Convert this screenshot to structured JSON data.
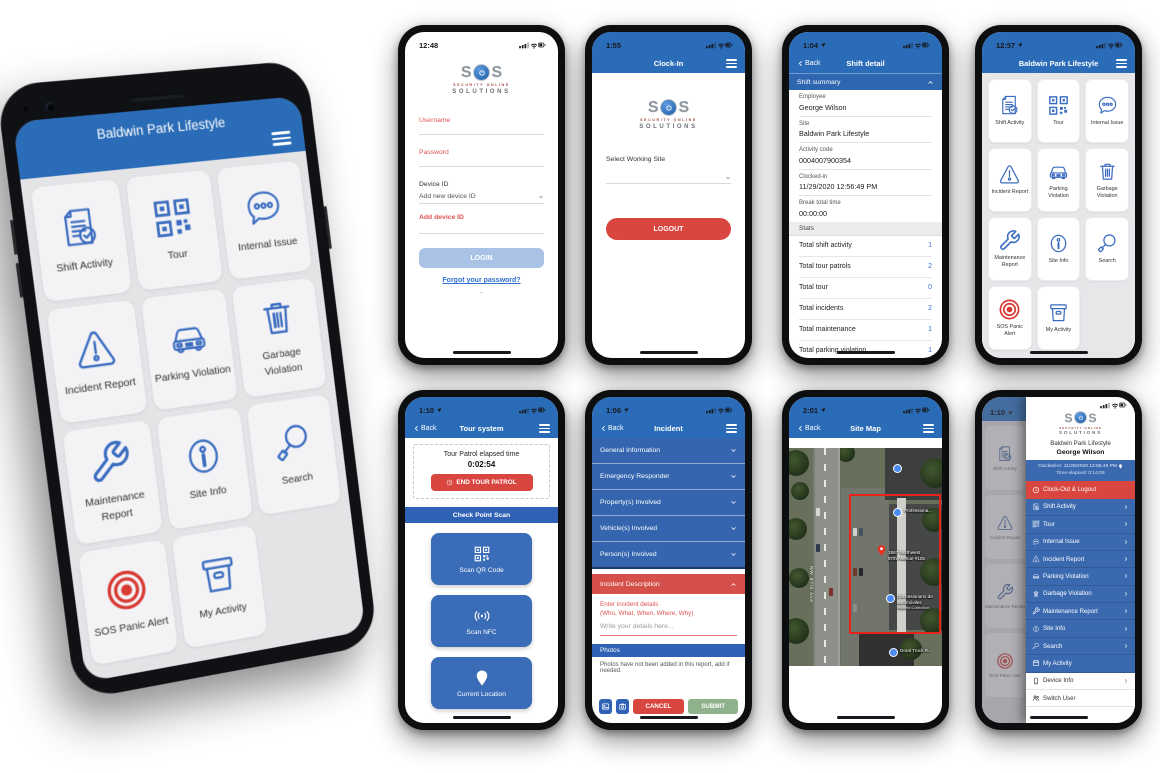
{
  "main_title": "Baldwin Park Lifestyle",
  "nav": {
    "back": "Back"
  },
  "logo": {
    "s_left": "S",
    "s_right": "S",
    "tagline1": "SECURITY ONLINE",
    "tagline2": "SOLUTIONS"
  },
  "colors": {
    "header_blue": "#2a6cb8",
    "row_blue": "#3a69b0",
    "accent_red": "#d9453f",
    "panic_red": "#d93a34",
    "icon_blue": "#3a6cc0",
    "submit_green": "#8fb18c",
    "login_button_blue": "#a9c2e6",
    "stat_value_blue": "#2f6fd0"
  },
  "status": {
    "login": "12:48",
    "clockin": "1:55",
    "shift": "1:04",
    "menu": "12:57",
    "tour": "1:10",
    "incident": "1:06",
    "map": "2:01",
    "drawer": "1:10"
  },
  "menu": {
    "items": [
      {
        "label": "Shift Activity"
      },
      {
        "label": "Tour"
      },
      {
        "label": "Internal Issue"
      },
      {
        "label": "Incident Report"
      },
      {
        "label": "Parking Violation"
      },
      {
        "label": "Garbage Violation"
      },
      {
        "label": "Maintenance Report"
      },
      {
        "label": "Site Info"
      },
      {
        "label": "Search"
      },
      {
        "label": "SOS Panic Alert"
      },
      {
        "label": "My Activity"
      }
    ]
  },
  "login": {
    "username_label": "Username",
    "password_label": "Password",
    "device_id_label": "Device ID",
    "device_id_value": "Add new device ID",
    "add_device_link": "Add device ID",
    "login_button": "LOGIN",
    "forgot_link": "Forgot your password?",
    "dash": "-"
  },
  "clockin": {
    "title": "Clock-In",
    "select_site_label": "Select Working Site",
    "logout_button": "LOGOUT"
  },
  "shift": {
    "title": "Shift detail",
    "summary_header": "Shift summary",
    "fields": [
      {
        "label": "Employee",
        "value": "George Wilson"
      },
      {
        "label": "Site",
        "value": "Baldwin Park Lifestyle"
      },
      {
        "label": "Activity code",
        "value": "0004007900354"
      },
      {
        "label": "Clocked-in",
        "value": "11/29/2020 12:56:49 PM"
      },
      {
        "label": "Break total time",
        "value": "00:00:00"
      }
    ],
    "stats_header": "Stats",
    "stats": [
      {
        "label": "Total shift activity",
        "value": "1"
      },
      {
        "label": "Total tour patrols",
        "value": "2"
      },
      {
        "label": "Total tour",
        "value": "0"
      },
      {
        "label": "Total incidents",
        "value": "2"
      },
      {
        "label": "Total maintenance",
        "value": "1"
      },
      {
        "label": "Total parking violation",
        "value": "1"
      }
    ]
  },
  "tour": {
    "title": "Tour system",
    "elapsed_label": "Tour Patrol elapsed time",
    "elapsed_time": "0:02:54",
    "end_button": "END TOUR PATROL",
    "checkpoint_header": "Check Point Scan",
    "scan_qr": "Scan QR Code",
    "scan_nfc": "Scan NFC",
    "current_location": "Current Location"
  },
  "incident": {
    "title": "Incident",
    "sections": [
      "General Information",
      "Emergency Responder",
      "Property(s) Involved",
      "Vehicle(s) Involved",
      "Person(s) Involved"
    ],
    "description_header": "Incident Description",
    "prompt_line1": "Enter incident details",
    "prompt_line2": "(Who, What, When, Where, Why)",
    "placeholder": "Write your details here...",
    "photos_header": "Photos",
    "photos_note": "Photos have not been added in this report, add if needed.",
    "cancel": "CANCEL",
    "submit": "SUBMIT"
  },
  "map": {
    "title": "Site Map",
    "street": "NW 97th Ave",
    "address_line1": "1867 Northwest",
    "address_line2": "97th Avenue #105",
    "poi1": "Professiona...",
    "poi2": "Concesionario de automóviles",
    "poi2_sub": "Imports Collection",
    "poi3": "Doral Truck R..."
  },
  "drawer": {
    "site": "Baldwin Park Lifestyle",
    "user": "George Wilson",
    "clocked_in": "Clocked-in: 11/29/2020 12:56:49 PM",
    "time_elapsed": "Time elapsed: 0:14:09",
    "logout": "Clock-Out & Logout",
    "items": [
      "Shift Activity",
      "Tour",
      "Internal Issue",
      "Incident Report",
      "Parking Violation",
      "Garbage Violation",
      "Maintenance Report",
      "Site Info",
      "Search",
      "My Activity"
    ],
    "device_info": "Device Info",
    "switch_user": "Switch User"
  }
}
